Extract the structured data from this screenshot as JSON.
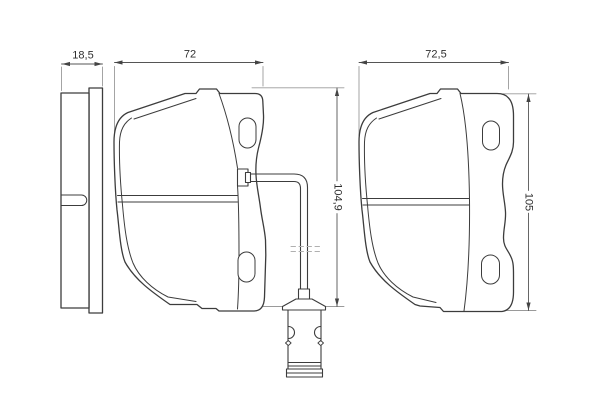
{
  "drawing": {
    "type": "technical-drawing",
    "subject": "disc brake pad set with wear sensor, three views",
    "background": "#ffffff",
    "outline_color": "#3c3c3c",
    "dimension_color": "#555555",
    "extension_color": "#9a9a9a",
    "labels": {
      "side_thickness": "18,5",
      "pad1_width": "72",
      "pad1_height": "104,9",
      "pad2_width": "72,5",
      "pad2_height": "105"
    }
  }
}
